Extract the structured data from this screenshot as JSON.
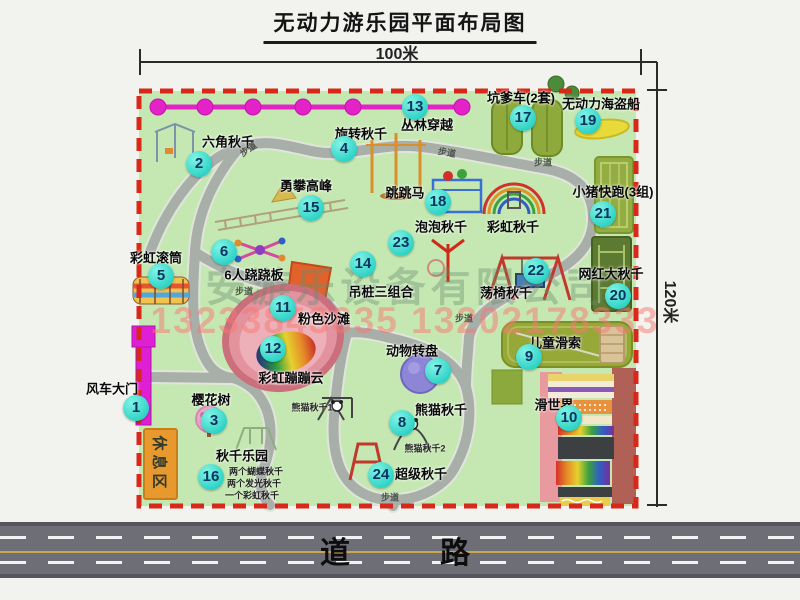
{
  "title": "无动力游乐园平面布局图",
  "dimensions": {
    "width_label": "100米",
    "height_label": "120米"
  },
  "road": {
    "label": "道　　路"
  },
  "watermark": {
    "company": "安游乐设备有限公司",
    "phone": "13233843635 13202178333"
  },
  "rest_area_label": "休息区",
  "rainbow_swing_label": "彩虹秋千",
  "colors": {
    "park_green": "#c5e8b2",
    "border_red": "#d8281a",
    "badge_cyan": "#2ed3c6",
    "path_gray": "#a8aea8",
    "road_gray": "#6e6e77",
    "gate_magenta": "#df1fd4",
    "rest_orange": "#e8992e",
    "beach_pink": "#e2939e"
  },
  "pois": [
    {
      "num": "1",
      "name": "风车大门",
      "bx": 136,
      "by": 408,
      "lx": 112,
      "ly": 388
    },
    {
      "num": "2",
      "name": "六角秋千",
      "bx": 199,
      "by": 164,
      "lx": 228,
      "ly": 141
    },
    {
      "num": "3",
      "name": "樱花树",
      "bx": 214,
      "by": 421,
      "lx": 211,
      "ly": 399
    },
    {
      "num": "4",
      "name": "旋转秋千",
      "bx": 344,
      "by": 149,
      "lx": 361,
      "ly": 133
    },
    {
      "num": "5",
      "name": "彩虹滚筒",
      "bx": 161,
      "by": 276,
      "lx": 156,
      "ly": 257
    },
    {
      "num": "6",
      "name": "6人跷跷板",
      "bx": 224,
      "by": 252,
      "lx": 254,
      "ly": 274
    },
    {
      "num": "7",
      "name": "动物转盘",
      "bx": 438,
      "by": 371,
      "lx": 412,
      "ly": 350
    },
    {
      "num": "8",
      "name": "熊猫秋千",
      "bx": 402,
      "by": 423,
      "lx": 441,
      "ly": 409
    },
    {
      "num": "9",
      "name": "儿童滑索",
      "bx": 529,
      "by": 357,
      "lx": 555,
      "ly": 342
    },
    {
      "num": "10",
      "name": "滑世界",
      "bx": 569,
      "by": 418,
      "lx": 554,
      "ly": 404
    },
    {
      "num": "11",
      "name": "粉色沙滩",
      "bx": 283,
      "by": 308,
      "lx": 324,
      "ly": 318
    },
    {
      "num": "12",
      "name": "彩虹蹦蹦云",
      "bx": 273,
      "by": 349,
      "lx": 291,
      "ly": 377
    },
    {
      "num": "13",
      "name": "丛林穿越",
      "bx": 415,
      "by": 107,
      "lx": 427,
      "ly": 124
    },
    {
      "num": "14",
      "name": "吊桩三组合",
      "bx": 363,
      "by": 264,
      "lx": 381,
      "ly": 291
    },
    {
      "num": "15",
      "name": "勇攀高峰",
      "bx": 311,
      "by": 208,
      "lx": 306,
      "ly": 185
    },
    {
      "num": "16",
      "name": "秋千乐园",
      "bx": 211,
      "by": 477,
      "lx": 242,
      "ly": 455
    },
    {
      "num": "17",
      "name": "坑爹车(2套)",
      "bx": 523,
      "by": 118,
      "lx": 521,
      "ly": 97
    },
    {
      "num": "18",
      "name": "跳跳马",
      "bx": 438,
      "by": 202,
      "lx": 405,
      "ly": 192
    },
    {
      "num": "19",
      "name": "无动力海盗船",
      "bx": 588,
      "by": 121,
      "lx": 601,
      "ly": 103
    },
    {
      "num": "20",
      "name": "网红大秋千",
      "bx": 618,
      "by": 296,
      "lx": 611,
      "ly": 273
    },
    {
      "num": "21",
      "name": "小猪快跑(3组)",
      "bx": 603,
      "by": 214,
      "lx": 613,
      "ly": 191
    },
    {
      "num": "22",
      "name": "荡椅秋千",
      "bx": 536,
      "by": 271,
      "lx": 506,
      "ly": 292
    },
    {
      "num": "23",
      "name": "泡泡秋千",
      "bx": 401,
      "by": 243,
      "lx": 441,
      "ly": 226
    },
    {
      "num": "24",
      "name": "超级秋千",
      "bx": 381,
      "by": 475,
      "lx": 421,
      "ly": 473
    }
  ],
  "walk_labels": [
    {
      "text": "步道",
      "x": 248,
      "y": 149,
      "rot": -35
    },
    {
      "text": "步道",
      "x": 447,
      "y": 152,
      "rot": 10
    },
    {
      "text": "步道",
      "x": 543,
      "y": 162,
      "rot": 0
    },
    {
      "text": "步道",
      "x": 244,
      "y": 291,
      "rot": 0
    },
    {
      "text": "步道",
      "x": 464,
      "y": 318,
      "rot": 0
    },
    {
      "text": "步道",
      "x": 390,
      "y": 497,
      "rot": 0
    }
  ],
  "panda_notes": [
    "熊猫秋千1",
    "熊猫秋千2"
  ],
  "panda_note_pos": [
    {
      "x": 312,
      "y": 407
    },
    {
      "x": 425,
      "y": 448
    }
  ],
  "swing_park_notes": [
    "两个蝴蝶秋千",
    "两个发光秋千",
    "一个彩虹秋千"
  ],
  "swing_park_note_pos": [
    {
      "x": 256,
      "y": 471
    },
    {
      "x": 254,
      "y": 483
    },
    {
      "x": 252,
      "y": 495
    }
  ]
}
